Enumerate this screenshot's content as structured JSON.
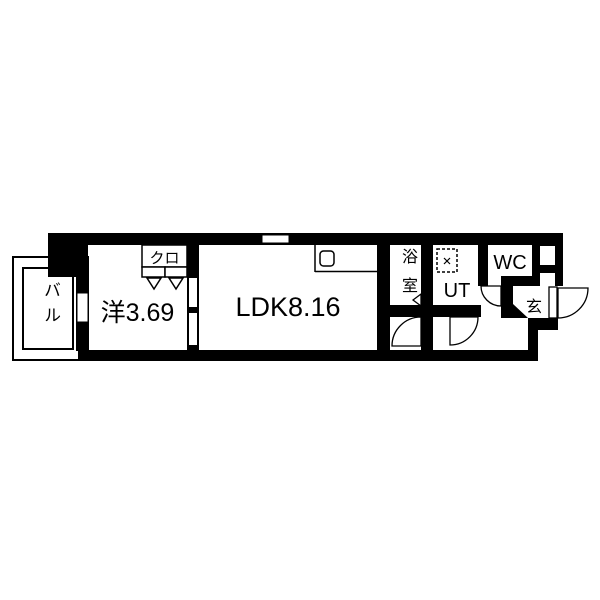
{
  "floorplan": {
    "rooms": {
      "balcony": {
        "label": "バル"
      },
      "western_room": {
        "label": "洋3.69"
      },
      "closet": {
        "label": "クロ"
      },
      "ldk": {
        "label": "LDK8.16"
      },
      "bathroom": {
        "label": "浴室"
      },
      "utility": {
        "label": "UT"
      },
      "toilet": {
        "label": "WC"
      },
      "entrance": {
        "label": "玄"
      }
    },
    "symbols": {
      "washing_machine": "dashed-square",
      "kitchen_sink": "rounded-rect",
      "door_swing": "quarter-arc",
      "folding_door_marker": "triangle"
    },
    "colors": {
      "wall": "#000000",
      "floor": "#ffffff"
    }
  }
}
